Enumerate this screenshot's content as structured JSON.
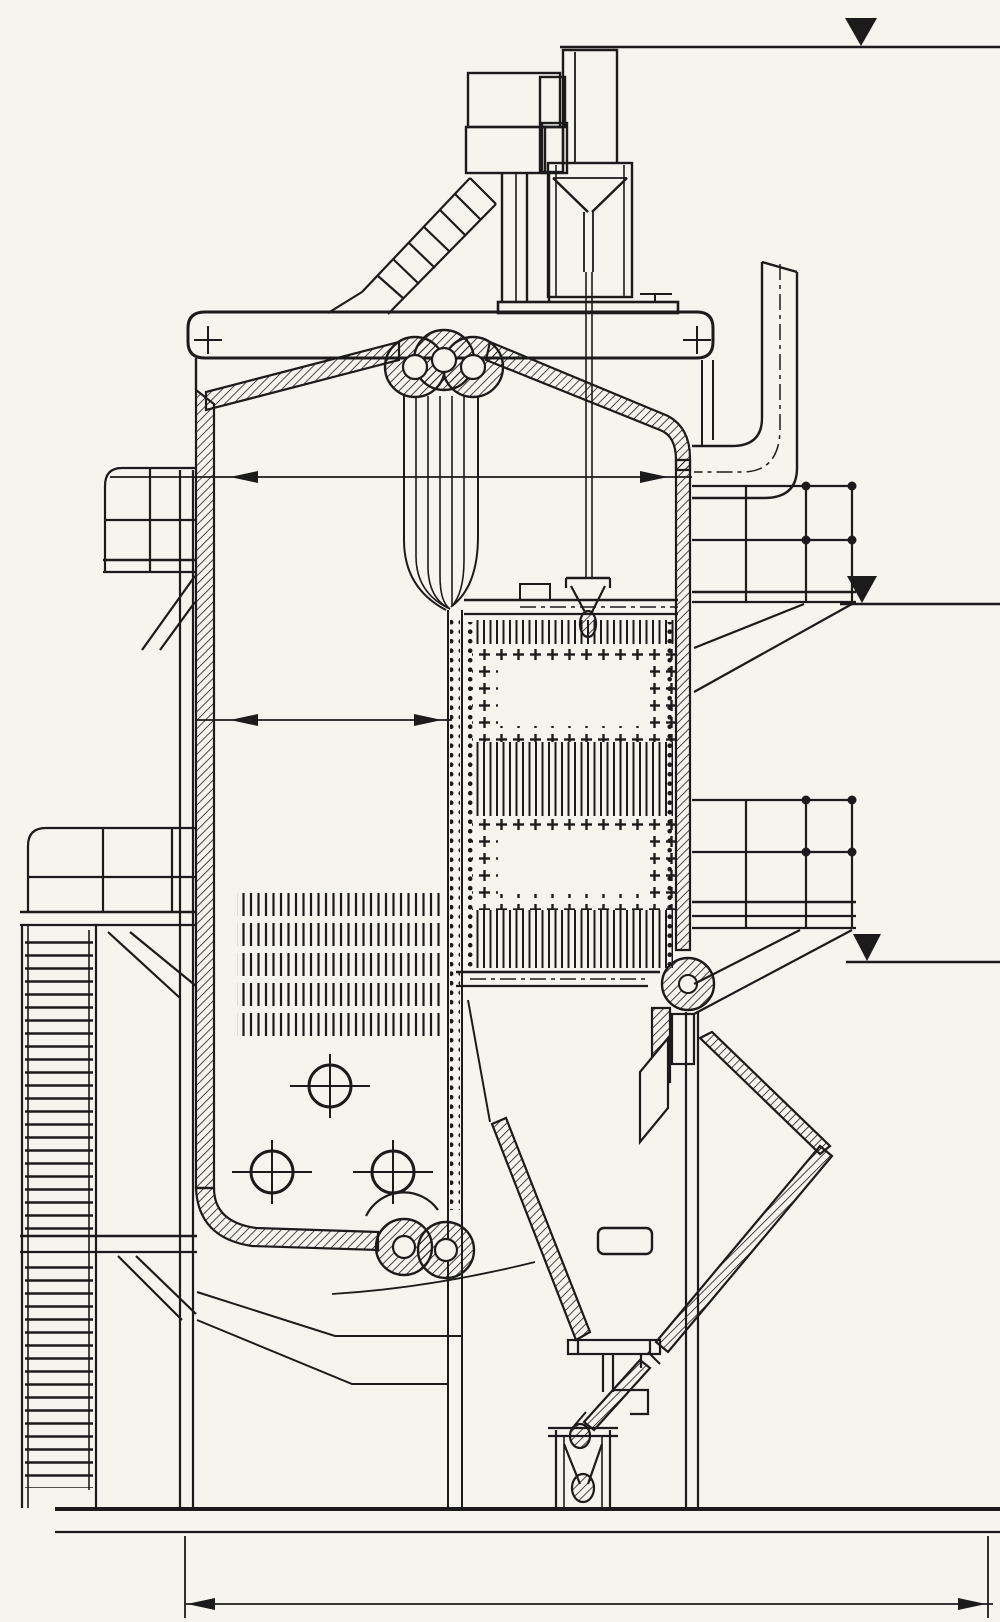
{
  "document": {
    "kind": "technical sectional drawing of a vertical boiler",
    "paper_color": "#f6f4ef",
    "ink_color": "#1b1b1b"
  },
  "elevations": {
    "top": {
      "value": "14677"
    },
    "middle": {
      "value": "8850"
    },
    "lower": {
      "value": "5370"
    }
  },
  "dimensions": {
    "top_width": {
      "value": "4480"
    },
    "furnace_width": {
      "value": "2240"
    },
    "base_width": {
      "value": "2820"
    }
  }
}
